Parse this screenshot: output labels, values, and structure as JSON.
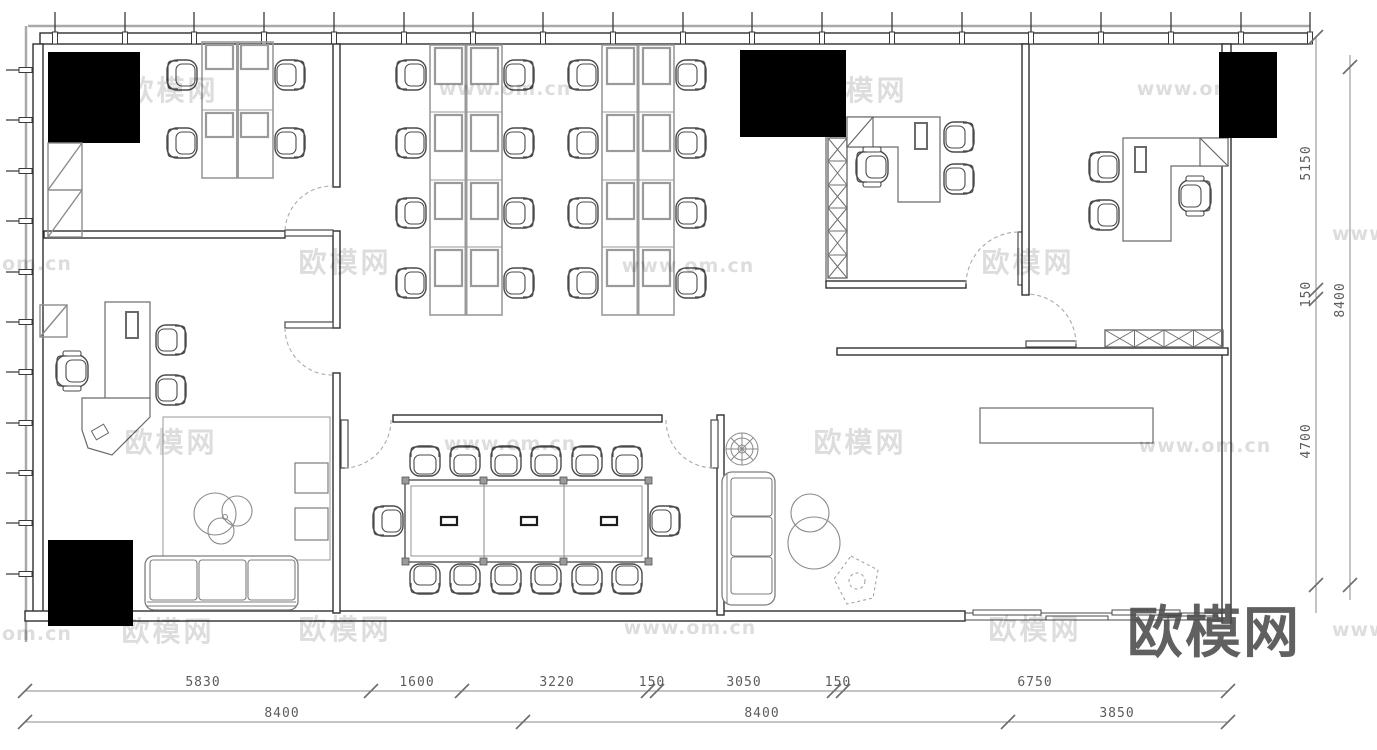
{
  "drawing": {
    "type": "office-floor-plan"
  },
  "dimensions": {
    "bottom_row1": [
      "5830",
      "1600",
      "3220",
      "150",
      "3050",
      "150",
      "6750"
    ],
    "bottom_row2": [
      "8400",
      "8400",
      "3850"
    ],
    "right_inner": [
      "5150",
      "150",
      "4700"
    ],
    "right_outer": "8400"
  },
  "watermark": {
    "brand": "欧模网",
    "site": "www.om.cn",
    "partial_left": "om.cn",
    "partial_right": "www.o"
  },
  "logo": {
    "text": "欧模网"
  },
  "colors": {
    "wall_line": "#2f2f2f",
    "furniture_gray": "#9a9a9a",
    "furniture_dark": "#5a5a5a",
    "dim_line": "#8a8a8a",
    "door_arc": "#aaaaaa",
    "redaction": "#000000",
    "logo_gray": "#4b4b4b"
  }
}
